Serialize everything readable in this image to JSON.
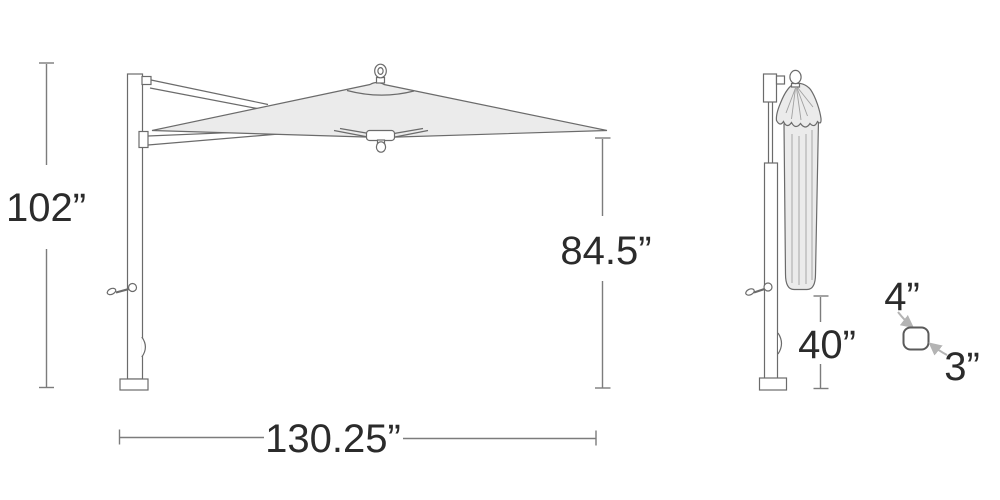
{
  "colors": {
    "background": "#ffffff",
    "line_color": "#6b6b6b",
    "dim_line_color": "#7c7c7c",
    "text_color": "#2b2b2b",
    "canopy_fill": "#ebebeb",
    "arrow_color": "#b4b4b4"
  },
  "open_view": {
    "height_label": "102”",
    "clearance_label": "84.5”",
    "width_label": "130.25”"
  },
  "folded_view": {
    "folded_height_label": "40”"
  },
  "pole_detail": {
    "depth_label": "4”",
    "width_label": "3”"
  }
}
